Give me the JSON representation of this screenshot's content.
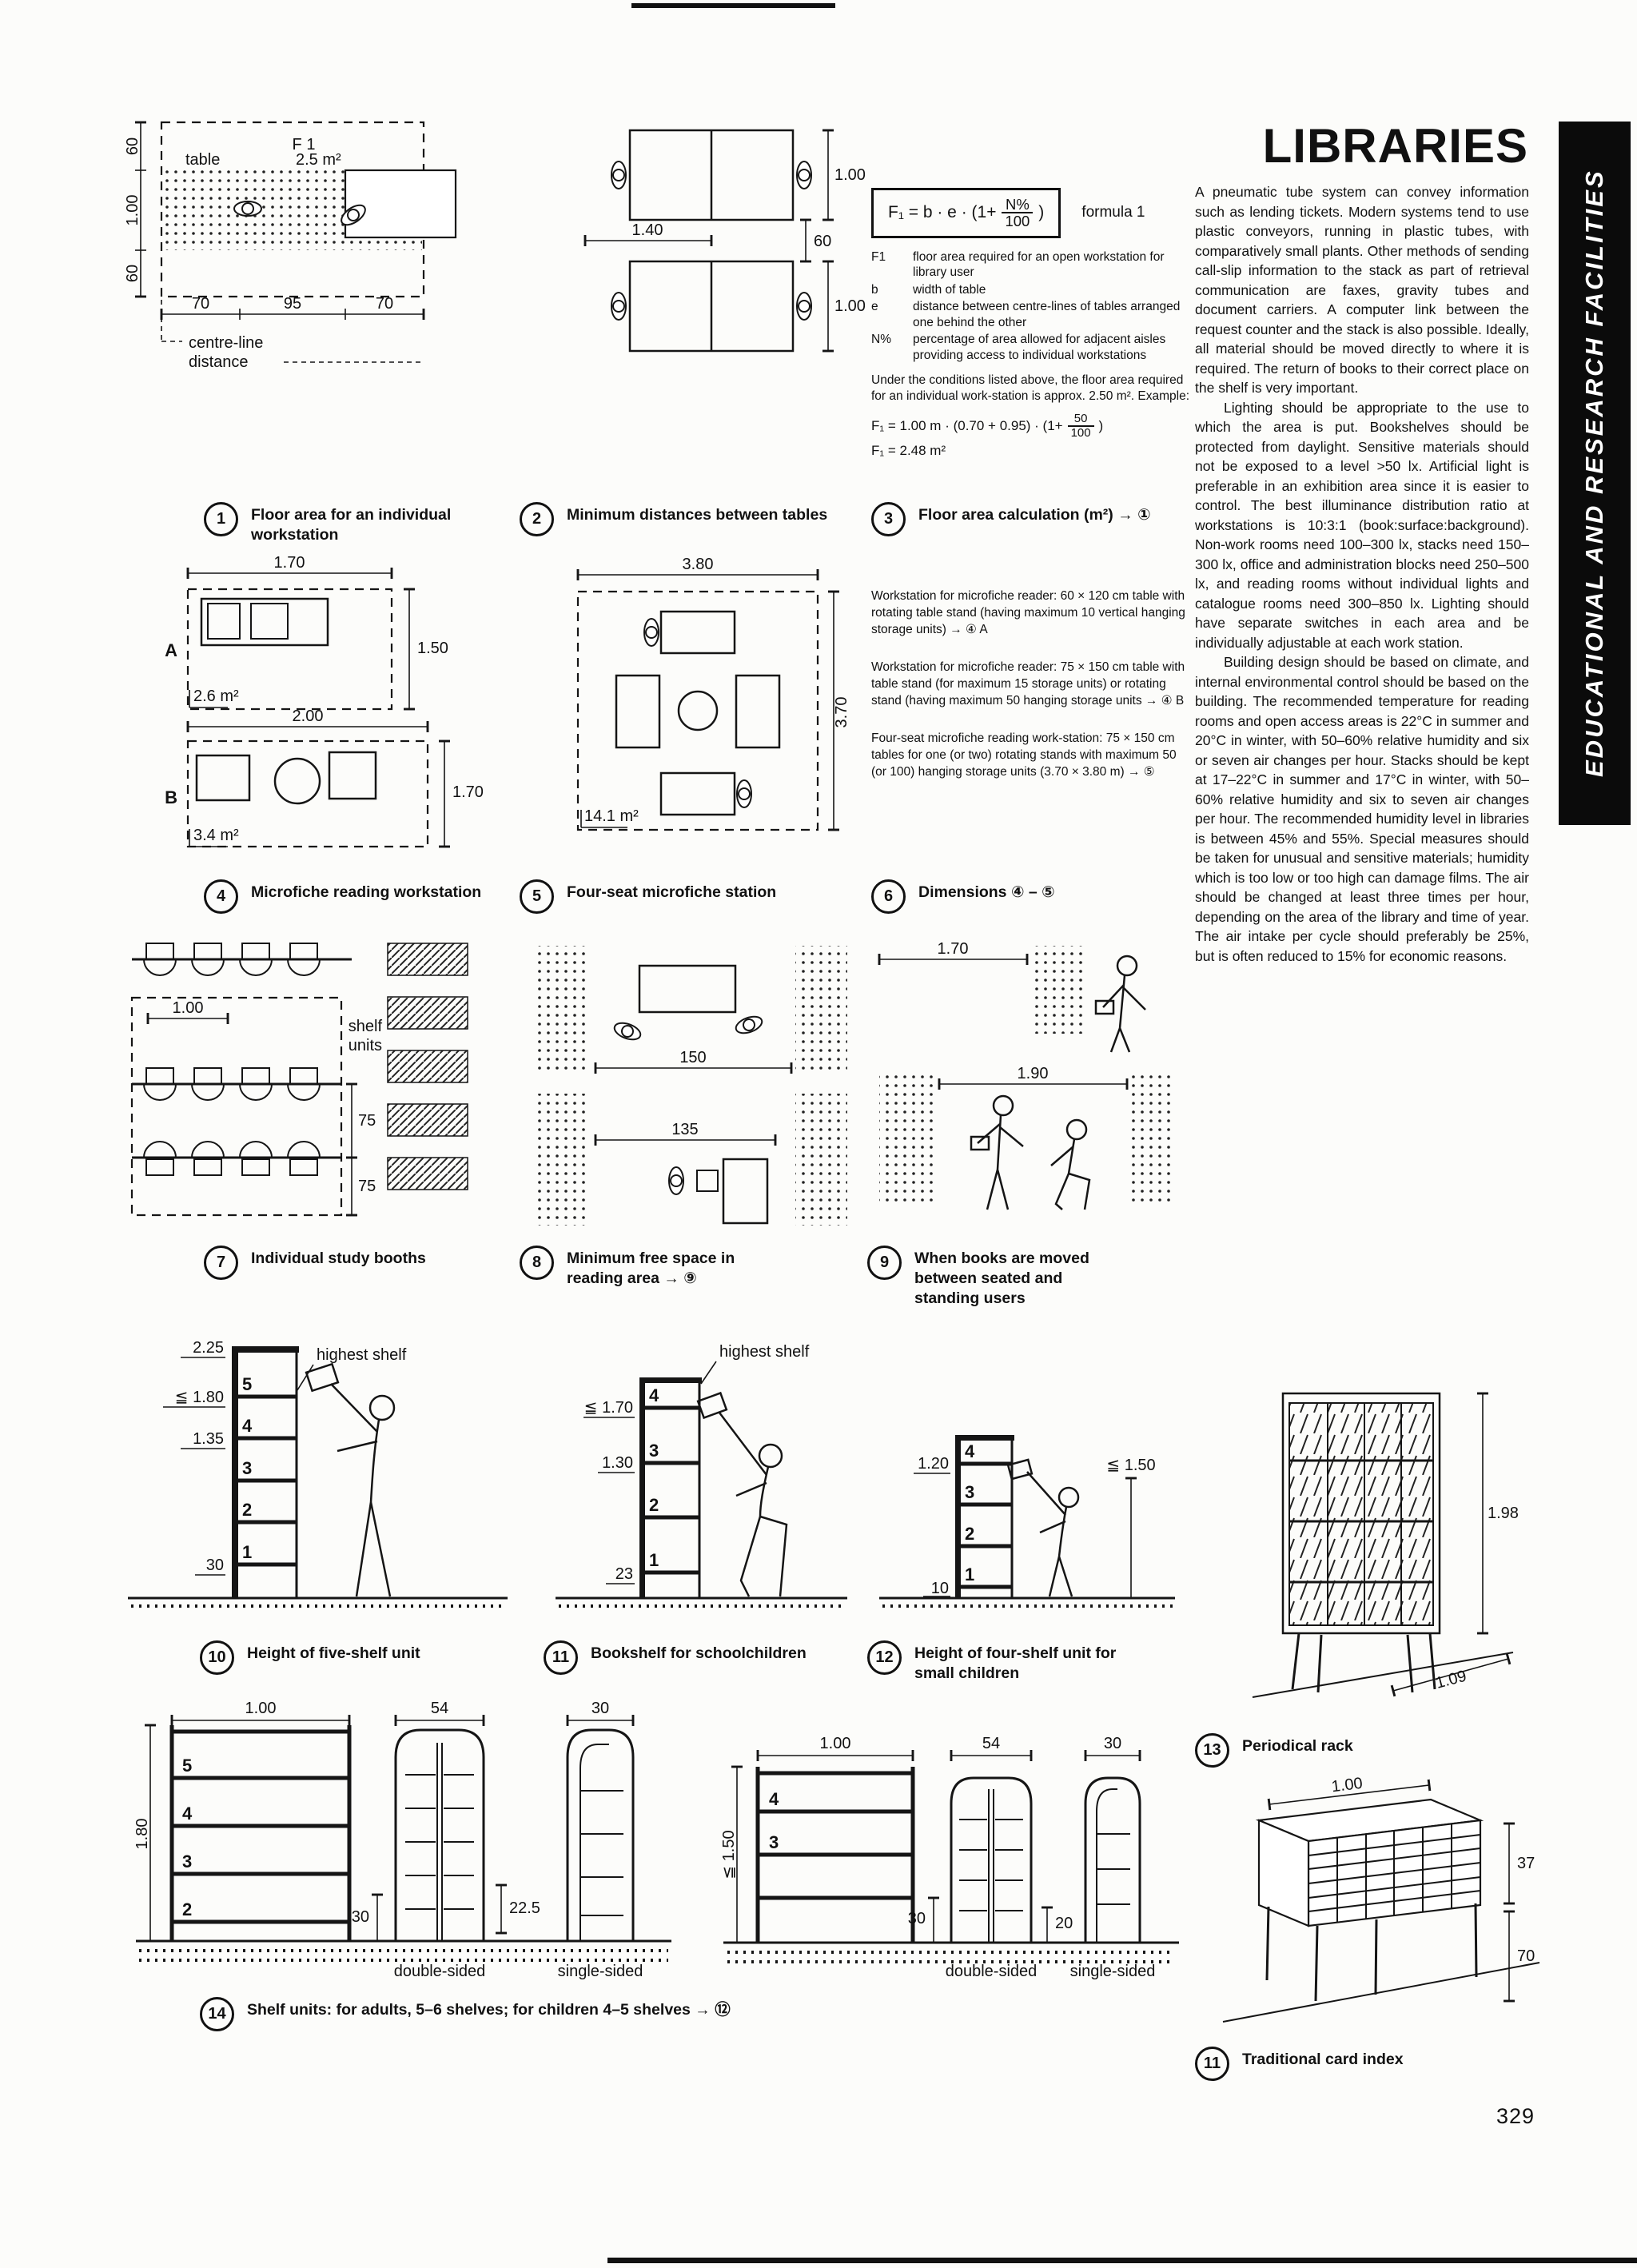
{
  "page": {
    "title": "LIBRARIES",
    "number": "329",
    "banner": "EDUCATIONAL AND RESEARCH FACILITIES"
  },
  "body": {
    "para1": "A pneumatic tube system can convey information such as lending tickets. Modern systems tend to use plastic conveyors, running in plastic tubes, with comparatively small plants. Other methods of sending call-slip information to the stack as part of retrieval communication are faxes, gravity tubes and document carriers. A computer link between the request counter and the stack is also possible. Ideally, all material should be moved directly to where it is required. The return of books to their correct place on the shelf is very important.",
    "para2": "Lighting should be appropriate to the use to which the area is put. Bookshelves should be protected from daylight. Sensitive materials should not be exposed to a level >50 lx. Artificial light is preferable in an exhibition area since it is easier to control. The best illuminance distribution ratio at workstations is 10:3:1 (book:surface:background). Non-work rooms need 100–300 lx, stacks need 150–300 lx, office and administration blocks need 250–500 lx, and reading rooms without individual lights and catalogue rooms need 300–850 lx. Lighting should have separate switches in each area and be individually adjustable at each work station.",
    "para3": "Building design should be based on climate, and internal environmental control should be based on the building. The recommended temperature for reading rooms and open access areas is 22°C in summer and 20°C in winter, with 50–60% relative humidity and six or seven air changes per hour. Stacks should be kept at 17–22°C in summer and 17°C in winter, with 50–60% relative humidity and six to seven air changes per hour. The recommended humidity level in libraries is between 45% and 55%. Special measures should be taken for unusual and sensitive materials; humidity which is too low or too high can damage films. The air should be changed at least three times per hour, depending on the area of the library and time of year. The air intake per cycle should preferably be 25%, but is often reduced to 15% for economic reasons."
  },
  "formula": {
    "lhs": "F₁ = b · e · (1+",
    "num": "N%",
    "den": "100",
    "close": ")",
    "tag": "formula 1",
    "terms": {
      "t1": "F1",
      "t2": "b",
      "t3": "e",
      "t4": "N%"
    },
    "defs": {
      "d1": "floor area required for an open workstation for library user",
      "d2": "width of table",
      "d3": "distance between centre-lines of tables arranged one behind the other",
      "d4": "percentage of area allowed for adjacent aisles providing access to individual workstations"
    },
    "note": "Under the conditions listed above, the floor area required for an individual work-station is approx. 2.50 m². Example:",
    "ex_lhs": "F₁ = 1.00 m · (0.70 + 0.95) · (1+",
    "ex_num": "50",
    "ex_den": "100",
    "ex_close": ")",
    "ex2": "F₁ = 2.48 m²"
  },
  "micro": {
    "p1": "Workstation for microfiche reader: 60 × 120 cm table with rotating table stand (having maximum 10 vertical hanging storage units) → ④ A",
    "p2": "Workstation for microfiche reader: 75 × 150 cm table with table stand (for maximum 15 storage units) or rotating stand (having maximum 50 hanging storage units → ④ B",
    "p3": "Four-seat microfiche reading work-station: 75 × 150 cm tables for one (or two) rotating stands with maximum 50 (or 100) hanging storage units (3.70 × 3.80 m) → ⑤"
  },
  "caps": {
    "c1": {
      "n": "1",
      "t": "Floor area for an individual workstation"
    },
    "c2": {
      "n": "2",
      "t": "Minimum distances between tables"
    },
    "c3": {
      "n": "3",
      "t": "Floor area calculation (m²) → ①"
    },
    "c4": {
      "n": "4",
      "t": "Microfiche reading workstation"
    },
    "c5": {
      "n": "5",
      "t": "Four-seat microfiche station"
    },
    "c6": {
      "n": "6",
      "t": "Dimensions ④ – ⑤"
    },
    "c7": {
      "n": "7",
      "t": "Individual study booths"
    },
    "c8": {
      "n": "8",
      "t": "Minimum free space in reading area → ⑨"
    },
    "c9": {
      "n": "9",
      "t": "When books are moved between seated and standing users"
    },
    "c10": {
      "n": "10",
      "t": "Height of five-shelf unit"
    },
    "c11": {
      "n": "11",
      "t": "Bookshelf for schoolchildren"
    },
    "c12": {
      "n": "12",
      "t": "Height of four-shelf unit for small children"
    },
    "c13": {
      "n": "13",
      "t": "Periodical rack"
    },
    "c14": {
      "n": "14",
      "t": "Shelf units: for adults, 5–6 shelves; for children 4–5 shelves → ⑫"
    },
    "c11b": {
      "n": "11",
      "t": "Traditional card index"
    }
  },
  "figs": {
    "f1": {
      "f1": "F 1",
      "table": "table",
      "area": "2.5 m²",
      "cl1": "centre-line",
      "cl2": "distance",
      "d1": "60",
      "d2": "1.00",
      "d3": "60",
      "d4": "70",
      "d5": "95",
      "d6": "70"
    },
    "f2": {
      "d1": "1.00",
      "d2": "1.40",
      "d3": "60",
      "d4": "1.00"
    },
    "f4": {
      "a": "A",
      "b": "B",
      "areaA": "2.6 m²",
      "areaB": "3.4 m²",
      "d1": "1.70",
      "d2": "1.50",
      "d3": "2.00",
      "d4": "1.70"
    },
    "f5": {
      "d1": "3.80",
      "d2": "3.70",
      "area": "14.1 m²"
    },
    "f7": {
      "d1": "1.00",
      "d2": "75",
      "d3": "75",
      "lbl1": "shelf",
      "lbl2": "units"
    },
    "f8": {
      "d1": "150",
      "d2": "135"
    },
    "f9": {
      "d1": "1.70",
      "d2": "1.90"
    },
    "f10": {
      "d1": "2.25",
      "d2": "≦ 1.80",
      "d3": "1.35",
      "d4": "30",
      "s1": "1",
      "s2": "2",
      "s3": "3",
      "s4": "4",
      "s5": "5",
      "hs": "highest shelf"
    },
    "f11": {
      "d1": "≦ 1.70",
      "d2": "1.30",
      "d3": "23",
      "s1": "1",
      "s2": "2",
      "s3": "3",
      "s4": "4",
      "hs": "highest shelf"
    },
    "f12": {
      "d1": "1.20",
      "d2": "≦ 1.50",
      "d3": "10",
      "s1": "1",
      "s2": "2",
      "s3": "3",
      "s4": "4"
    },
    "f13": {
      "d1": "1.98",
      "d2": "1.09"
    },
    "f14L": {
      "d1": "1.00",
      "d2": "54",
      "d3": "30",
      "d4": "1.80",
      "d5": "30",
      "d6": "22.5",
      "s5": "5",
      "s4": "4",
      "s3": "3",
      "s2": "2",
      "ds": "double-sided",
      "ss": "single-sided"
    },
    "f14R": {
      "d1": "1.00",
      "d2": "54",
      "d3": "30",
      "d4": "≦ 1.50",
      "d5": "30",
      "d6": "20",
      "s4": "4",
      "s3": "3",
      "ds": "double-sided",
      "ss": "single-sided"
    },
    "f11b": {
      "d1": "1.00",
      "d2": "37",
      "d3": "70"
    }
  }
}
